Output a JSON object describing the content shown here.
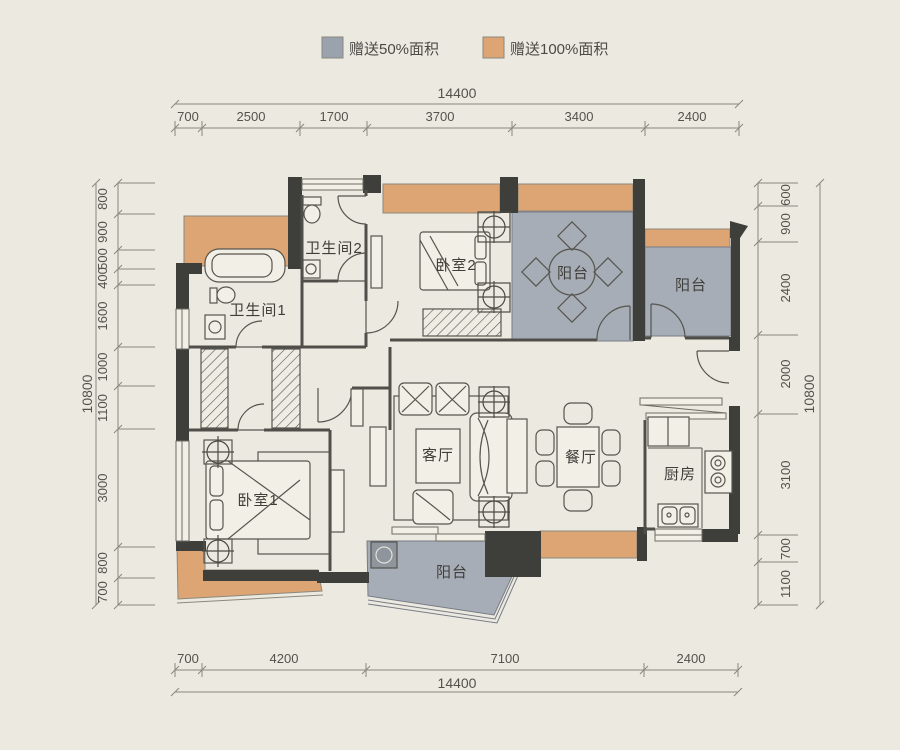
{
  "legend": {
    "items": [
      {
        "label": "赠送50%面积",
        "color": "#9aa2ae"
      },
      {
        "label": "赠送100%面积",
        "color": "#dda573"
      }
    ]
  },
  "rooms": {
    "bathroom2": "卫生间2",
    "bathroom1": "卫生间1",
    "bedroom2": "卧室2",
    "bedroom1": "卧室1",
    "living_room": "客厅",
    "dining_room": "餐厅",
    "kitchen": "厨房",
    "balcony_top": "阳台",
    "balcony_right": "阳台",
    "balcony_bottom": "阳台"
  },
  "dimensions": {
    "top": {
      "total": "14400",
      "segments": [
        "700",
        "2500",
        "1700",
        "3700",
        "3400",
        "2400"
      ]
    },
    "bottom": {
      "total": "14400",
      "segments": [
        "700",
        "4200",
        "7100",
        "2400"
      ]
    },
    "left": {
      "total": "10800",
      "segments": [
        "800",
        "900",
        "500",
        "400",
        "1600",
        "1000",
        "1100",
        "3000",
        "800",
        "700"
      ]
    },
    "right": {
      "total": "10800",
      "segments": [
        "600",
        "900",
        "2400",
        "2000",
        "3100",
        "700",
        "1100"
      ]
    }
  },
  "colors": {
    "gift50": "#9aa2ae",
    "gift100": "#dda573",
    "wall": "#3e3e3b",
    "paper": "#ece9e0"
  }
}
